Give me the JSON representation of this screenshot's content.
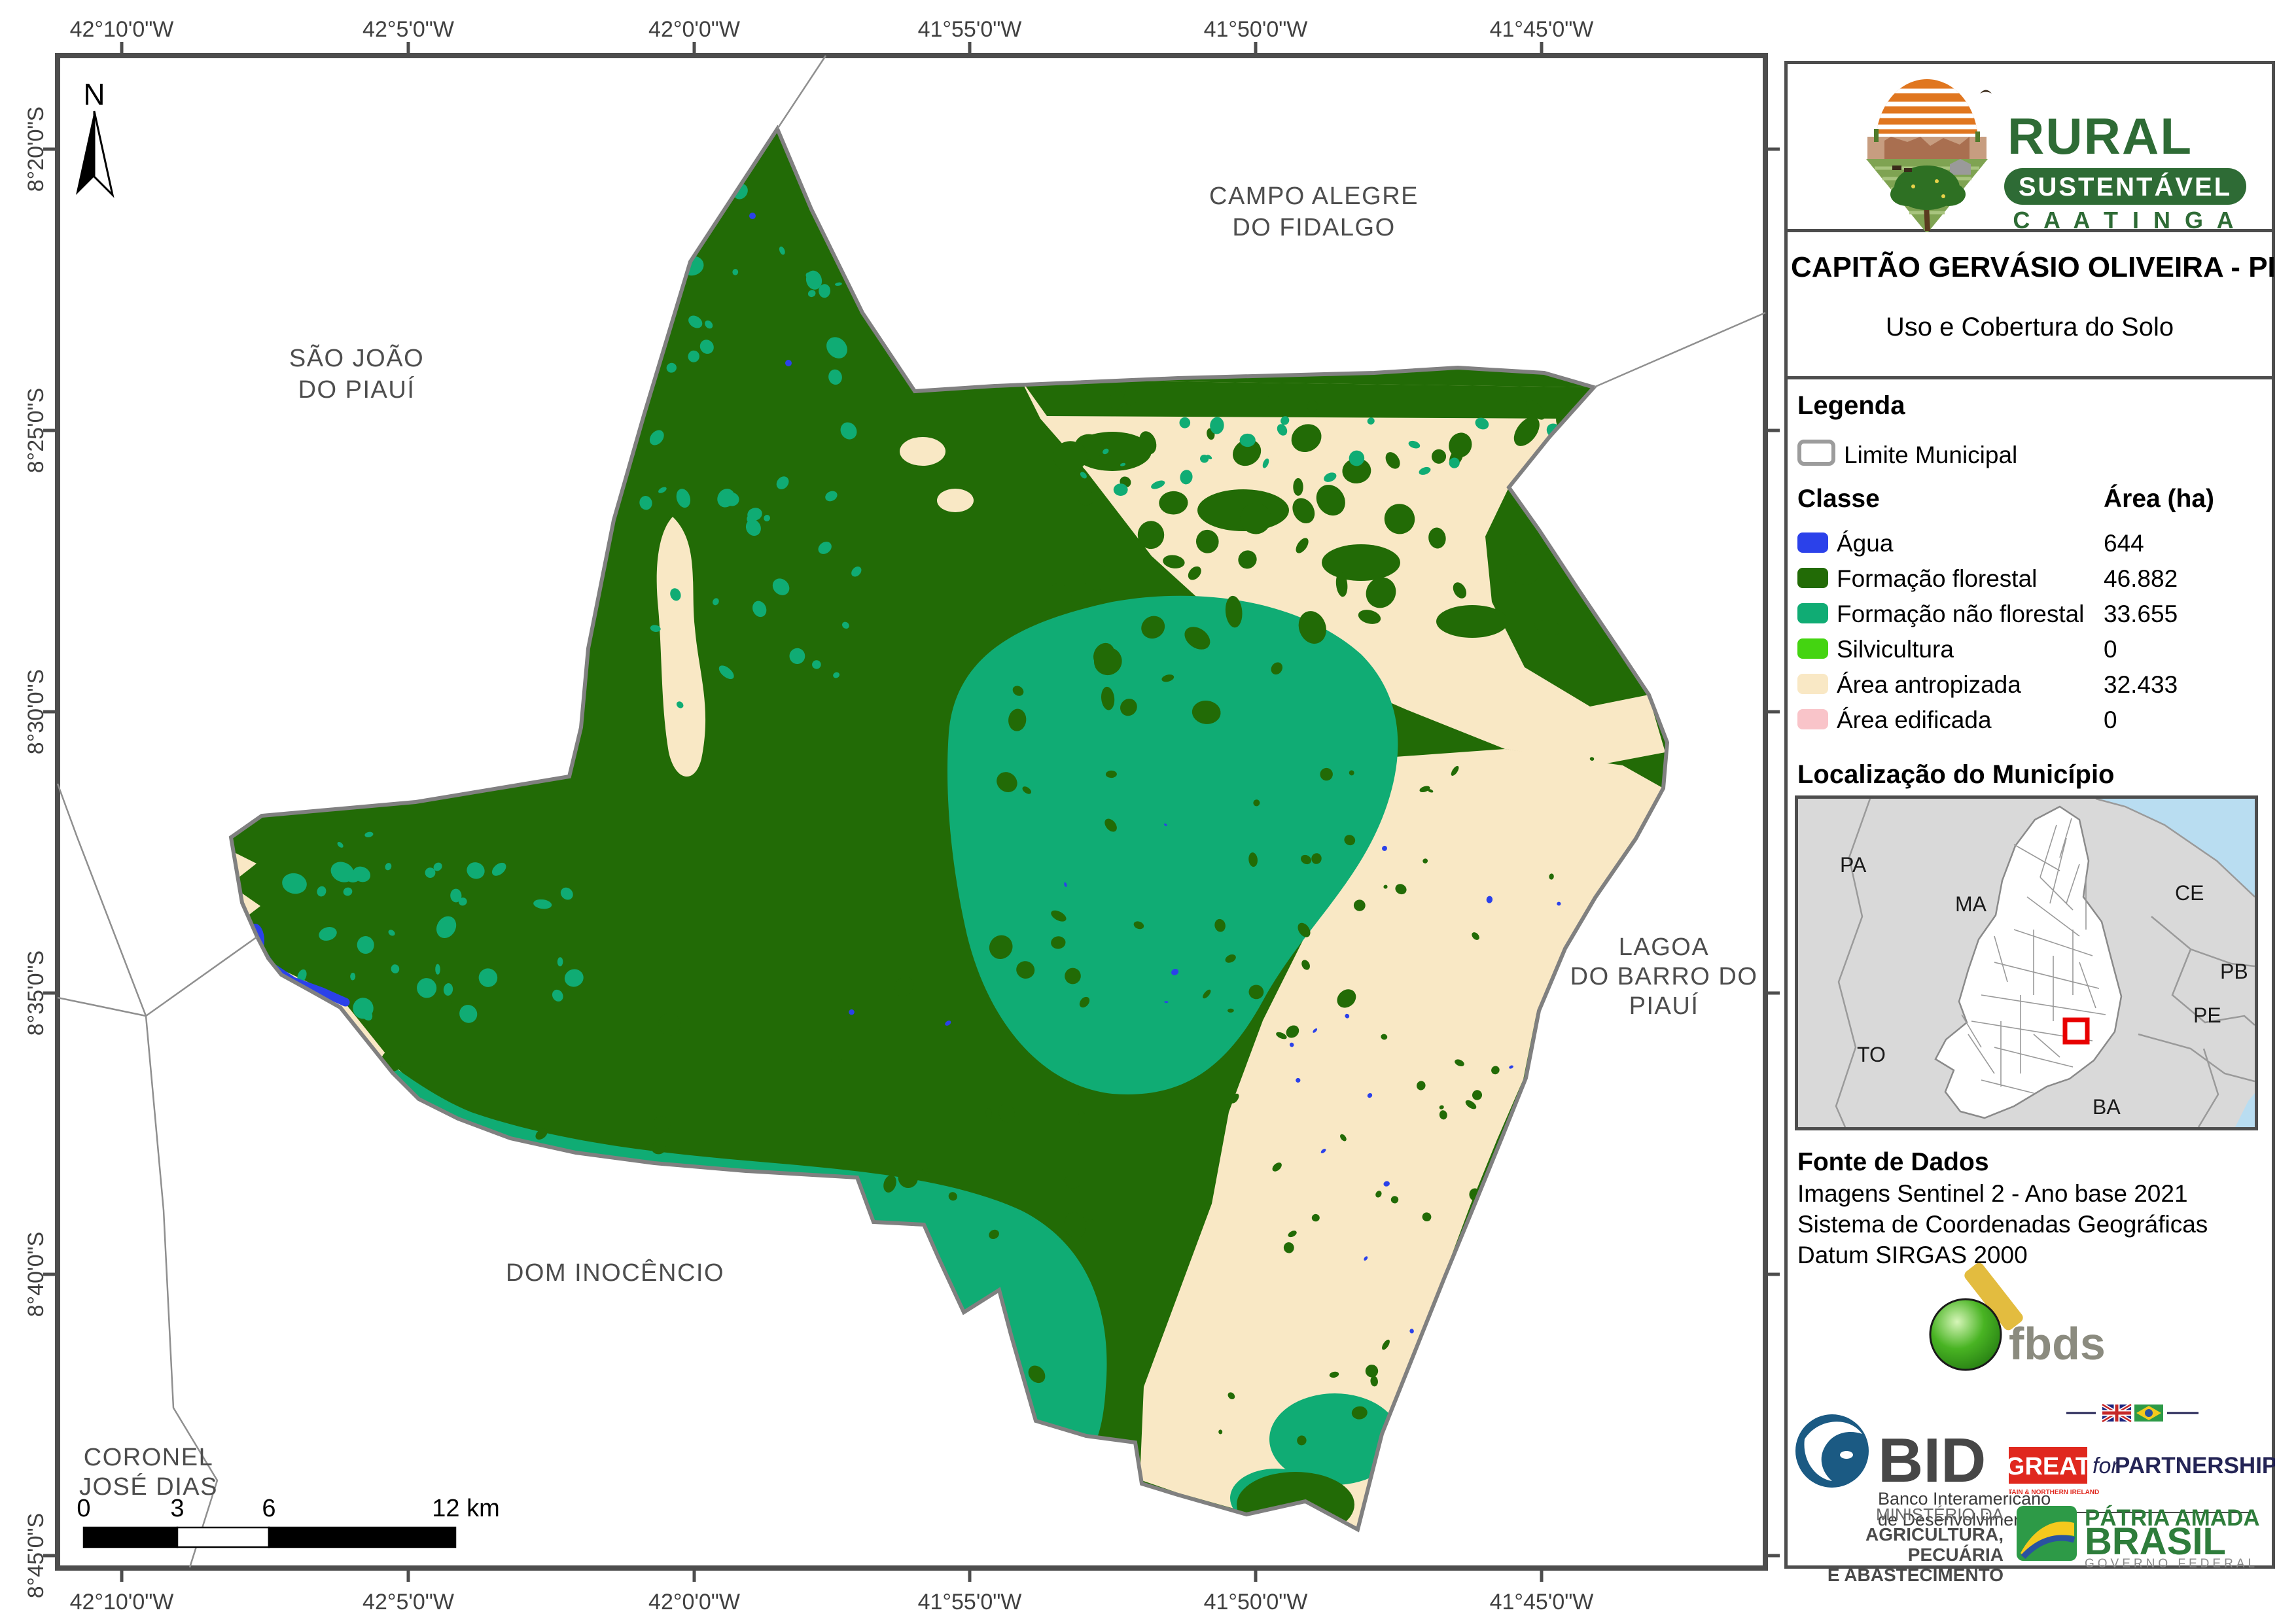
{
  "brand": {
    "name_top": "RURAL",
    "name_mid": "SUSTENTÁVEL",
    "name_bottom": "C A A T I N G A"
  },
  "title": {
    "line1": "CAPITÃO GERVÁSIO OLIVEIRA - PI",
    "line2": "Uso e Cobertura do Solo"
  },
  "legend": {
    "heading": "Legenda",
    "limite_label": "Limite Municipal",
    "col_class": "Classe",
    "col_area": "Área (ha)",
    "classes": [
      {
        "label": "Água",
        "area": "644",
        "color": "#2b41ea"
      },
      {
        "label": "Formação florestal",
        "area": "46.882",
        "color": "#226b06"
      },
      {
        "label": "Formação não florestal",
        "area": "33.655",
        "color": "#10ac74"
      },
      {
        "label": "Silvicultura",
        "area": "0",
        "color": "#44d411"
      },
      {
        "label": "Área antropizada",
        "area": "32.433",
        "color": "#f9e8c5"
      },
      {
        "label": "Área edificada",
        "area": "0",
        "color": "#f9c4c9"
      }
    ]
  },
  "location": {
    "heading": "Localização do Município",
    "states": [
      "PA",
      "MA",
      "CE",
      "PB",
      "PE",
      "TO",
      "BA"
    ]
  },
  "source": {
    "heading": "Fonte de Dados",
    "lines": [
      "Imagens Sentinel 2 - Ano base 2021",
      "Sistema de Coordenadas Geográficas",
      "Datum SIRGAS 2000"
    ]
  },
  "map": {
    "north": "N",
    "top_coords": [
      "42°10'0\"W",
      "42°5'0\"W",
      "42°0'0\"W",
      "41°55'0\"W",
      "41°50'0\"W",
      "41°45'0\"W"
    ],
    "bottom_coords": [
      "42°10'0\"W",
      "42°5'0\"W",
      "42°0'0\"W",
      "41°55'0\"W",
      "41°50'0\"W",
      "41°45'0\"W"
    ],
    "left_coords": [
      "8°20'0\"S",
      "8°25'0\"S",
      "8°30'0\"S",
      "8°35'0\"S",
      "8°40'0\"S",
      "8°45'0\"S"
    ],
    "scalebar": {
      "labels": [
        "0",
        "3",
        "6",
        "12 km"
      ]
    },
    "neighbors": {
      "sao_joao": {
        "lines": [
          "SÃO JOÃO",
          "DO PIAUÍ"
        ]
      },
      "campo": {
        "lines": [
          "CAMPO ALEGRE",
          "DO FIDALGO"
        ]
      },
      "lagoa": {
        "lines": [
          "LAGOA",
          "DO BARRO DO",
          "PIAUÍ"
        ]
      },
      "dom": {
        "lines": [
          "DOM INOCÊNCIO"
        ]
      },
      "coronel": {
        "lines": [
          "CORONEL",
          "JOSÉ DIAS"
        ]
      }
    }
  },
  "logos": {
    "fbds": {
      "text": "fbds"
    },
    "bid": {
      "name": "BID",
      "sub1": "Banco Interamericano",
      "sub2": "de Desenvolvimento"
    },
    "great": {
      "box": "GREAT",
      "for_word": "for",
      "partnership": "PARTNERSHIP",
      "sub": "BRITAIN & NORTHERN IRELAND"
    },
    "ministry": {
      "line1": "MINISTÉRIO DA",
      "line2": "AGRICULTURA, PECUÁRIA",
      "line3": "E ABASTECIMENTO"
    },
    "brasil": {
      "line1": "PÁTRIA AMADA",
      "line2": "BRASIL",
      "line3": "GOVERNO FEDERAL"
    }
  },
  "colors": {
    "agua": "#2b41ea",
    "formacao_florestal": "#226b06",
    "formacao_nao_florestal": "#10ac74",
    "silvicultura": "#44d411",
    "area_antropizada": "#f9e8c5",
    "area_edificada": "#f9c4c9",
    "limite": "#808080",
    "highlight_red": "#e80000"
  }
}
